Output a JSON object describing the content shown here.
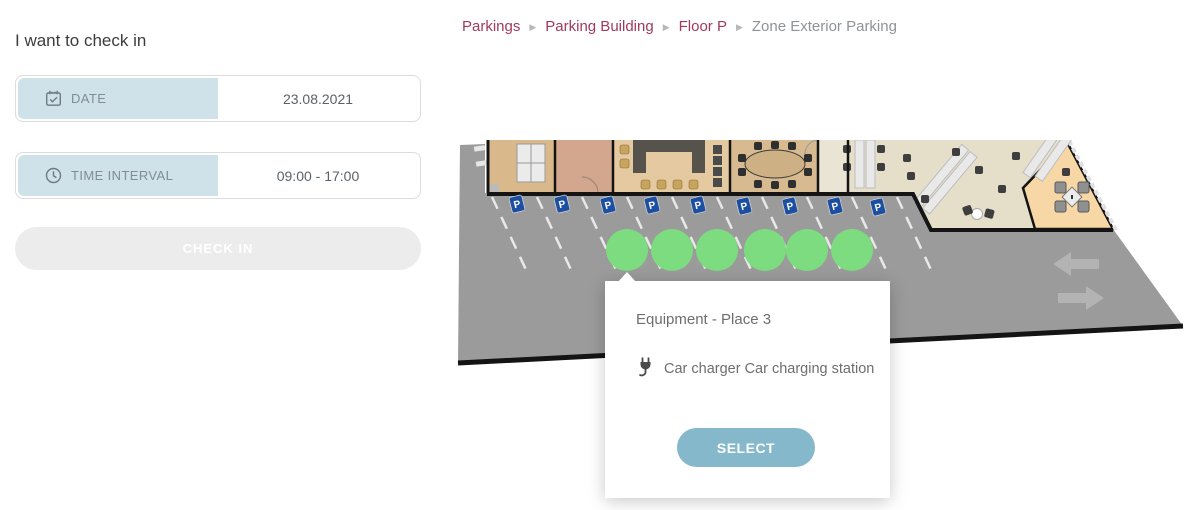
{
  "sidebar": {
    "title": "I want to check in",
    "date_field": {
      "label": "DATE",
      "value": "23.08.2021",
      "icon": "calendar-check-icon"
    },
    "time_field": {
      "label": "TIME INTERVAL",
      "value": "09:00 - 17:00",
      "icon": "clock-icon"
    },
    "checkin_button": "CHECK IN"
  },
  "breadcrumb": {
    "separator": "▶",
    "items": [
      {
        "label": "Parkings",
        "link": true
      },
      {
        "label": "Parking Building",
        "link": true
      },
      {
        "label": "Floor P",
        "link": true
      },
      {
        "label": "Zone Exterior Parking",
        "link": false
      }
    ]
  },
  "map": {
    "zone_name": "Zone Exterior Parking",
    "parking_sign_label": "P",
    "parking_sign_count": 9,
    "available_spot_count": 6
  },
  "popup": {
    "title": "Equipment - Place 3",
    "equipment_icon": "plug-icon",
    "equipment_text": "Car charger Car charging station",
    "select_button": "SELECT"
  },
  "colors": {
    "breadcrumb_link": "#a13a5e",
    "breadcrumb_current": "#8d9399",
    "field_label_bg": "#cfe2ea",
    "checkin_button_bg": "#ececec",
    "select_button_bg": "#86b8cb",
    "available_spot": "#7ddc80",
    "parking_sign_blue": "#1c4ea1",
    "asphalt": "#9b9b9b"
  }
}
